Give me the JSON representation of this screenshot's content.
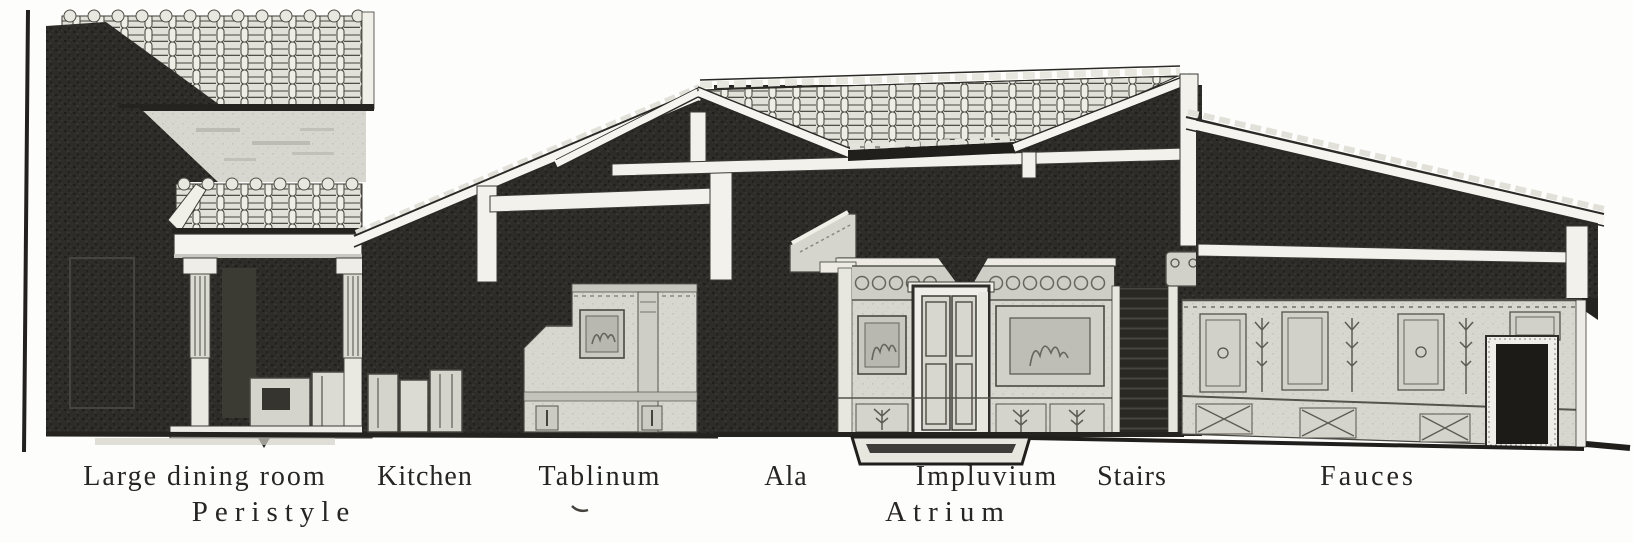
{
  "illustration": {
    "labels": {
      "row1": [
        {
          "text": "Large dining room"
        },
        {
          "text": "Kitchen"
        },
        {
          "text": "Tablinum"
        },
        {
          "text": "Ala"
        },
        {
          "text": "Impluvium"
        },
        {
          "text": "Stairs"
        },
        {
          "text": "Fauces"
        }
      ],
      "row2": [
        {
          "text": "Peristyle"
        },
        {
          "text": "Atrium"
        }
      ]
    },
    "colors": {
      "ink": "#262523",
      "paper": "#fdfdfb",
      "dark_wall": "#2d2c28",
      "light_wall": "#d8d7cf",
      "tile": "#e6e5dd",
      "beam_white": "#f5f4ef"
    }
  }
}
